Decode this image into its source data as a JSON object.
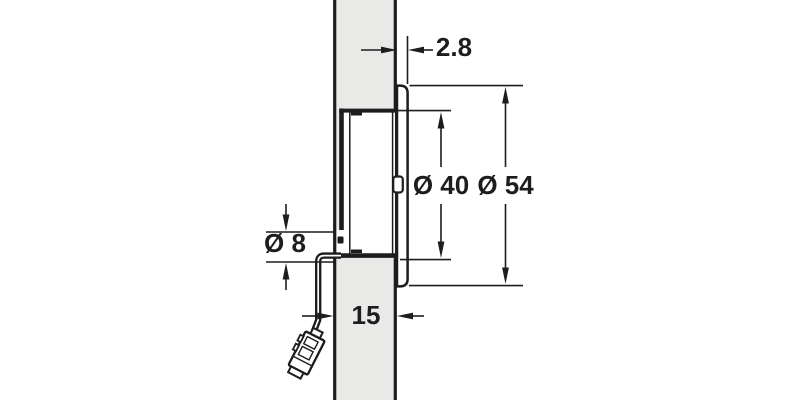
{
  "drawing": {
    "labels": {
      "flange_offset": "2.8",
      "recess_diameter": "Ø 40",
      "flange_diameter": "Ø 54",
      "cable_diameter": "Ø 8",
      "panel_thickness": "15"
    },
    "colors": {
      "line": "#1d1d1d",
      "panel_fill": "#e9e9e8",
      "background": "#ffffff"
    }
  }
}
